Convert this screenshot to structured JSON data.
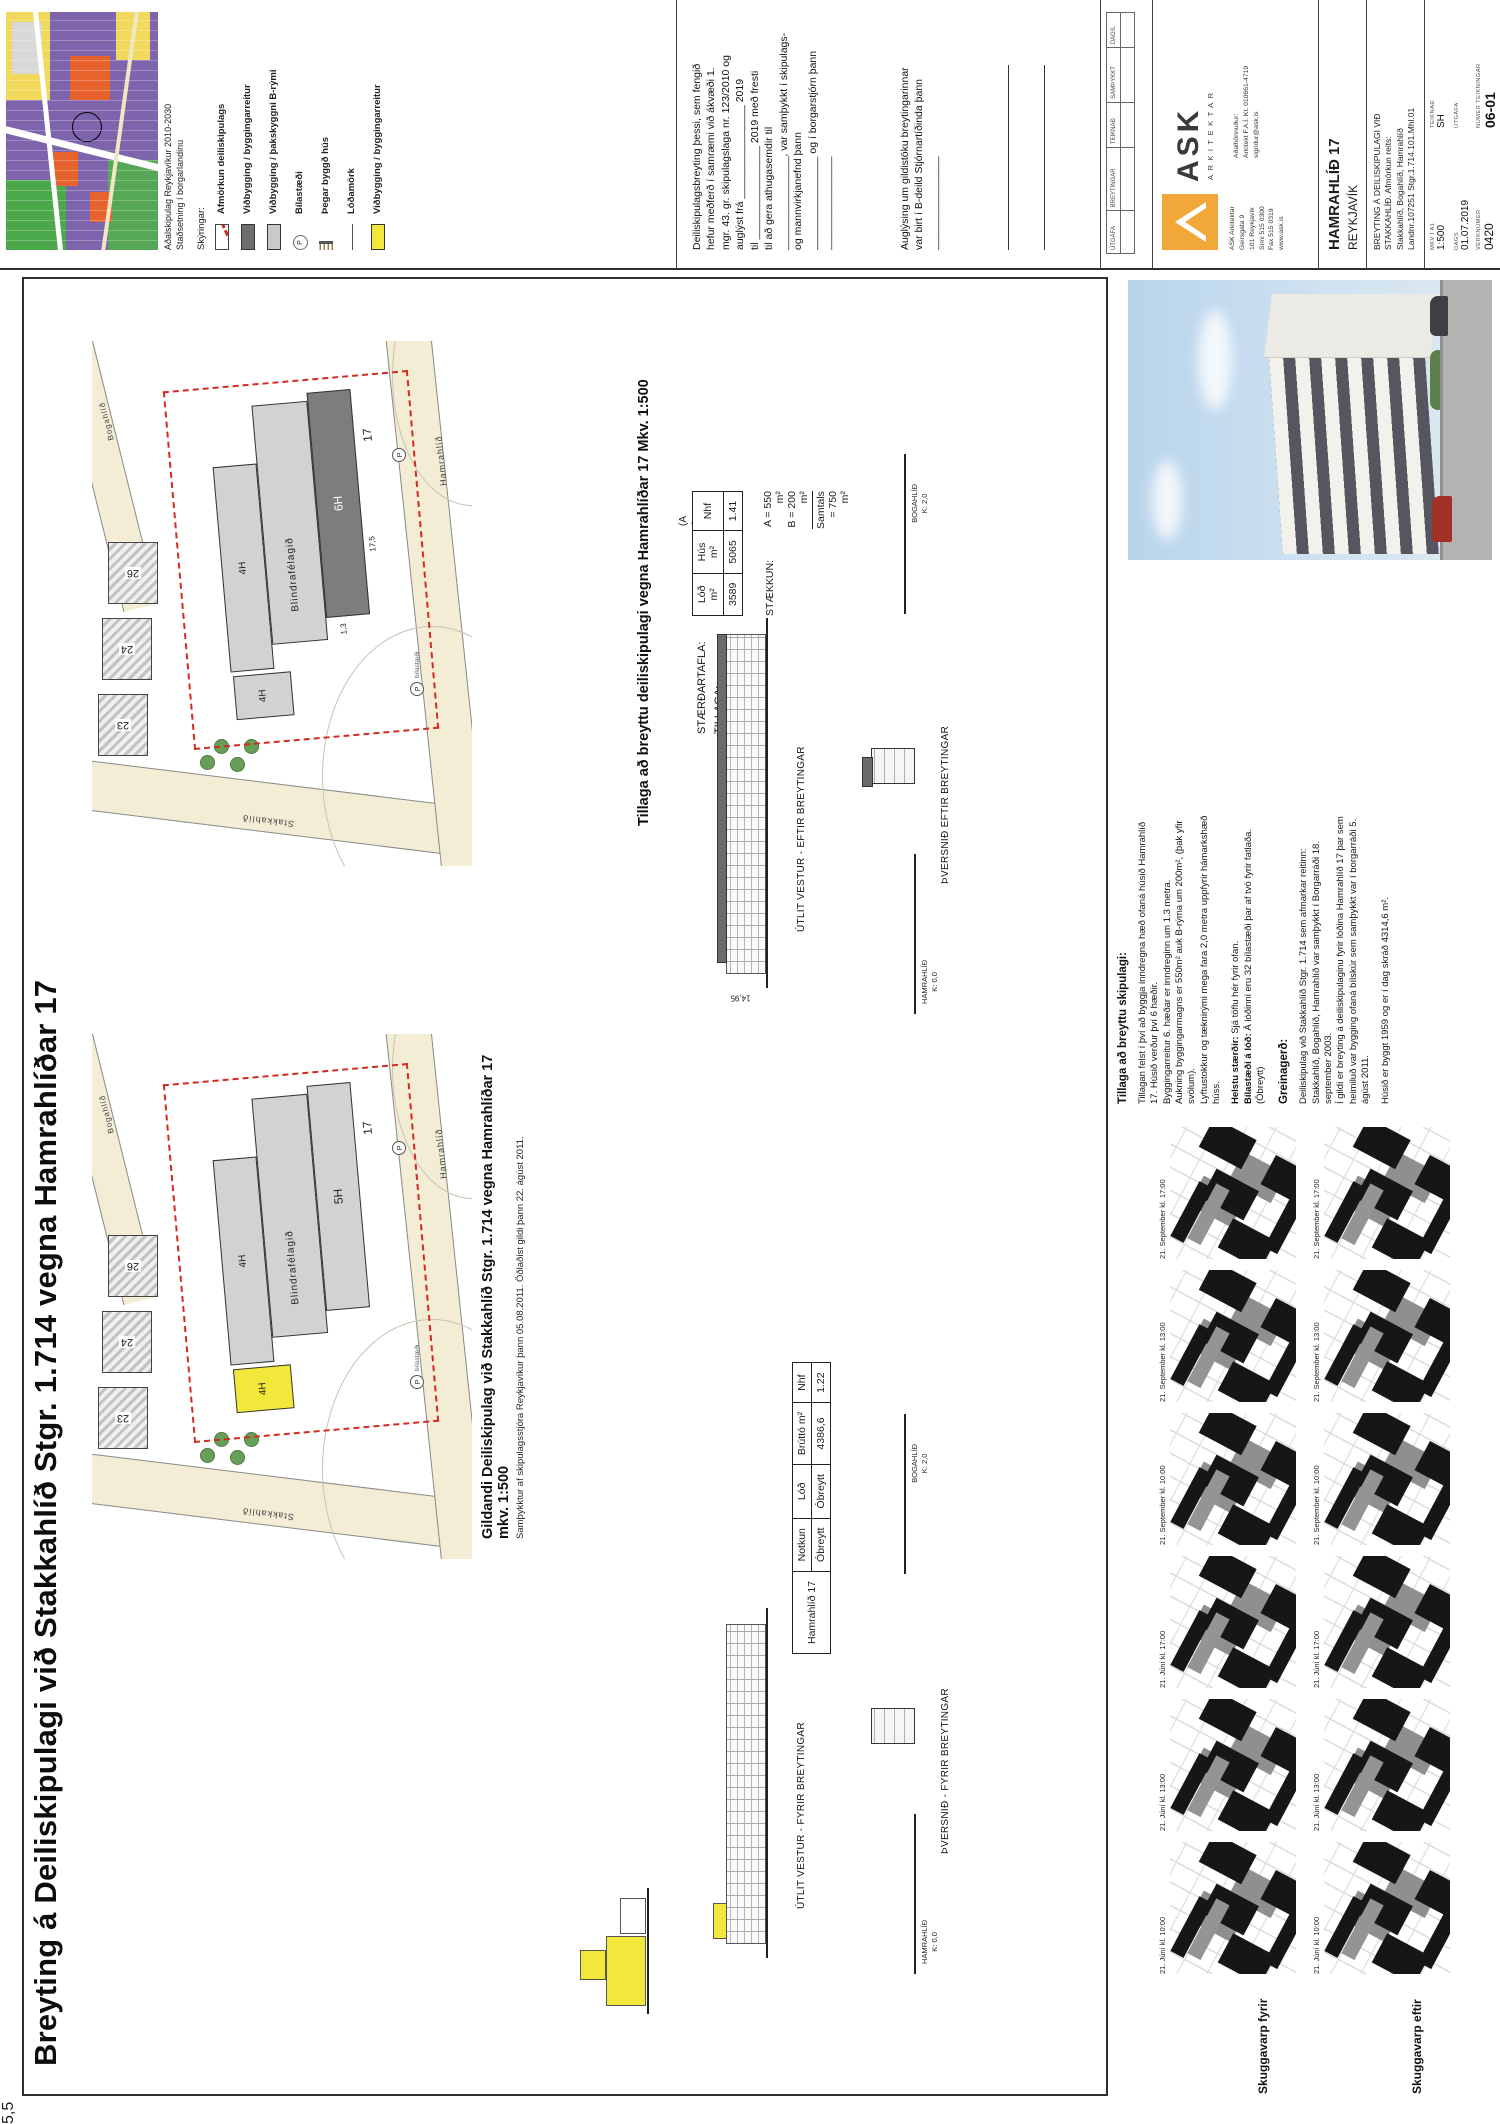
{
  "colors": {
    "accent_yellow": "#F2E83B",
    "boundary_red": "#D42A20",
    "ask_orange": "#F2A838",
    "addition_gray": "#6B6B6B"
  },
  "main_title": "Breyting á Deiliskipulagi við Stakkahlíð Stgr. 1.714 vegna Hamrahlíðar 17",
  "header": {
    "map_caption_line1": "Aðalskipulag Reykjavíkur 2010-2030",
    "map_caption_line2": "Staðsetning í borgarlandinu",
    "legend_title": "Skýringar:",
    "legend": [
      {
        "symbol": "red-dashed-box",
        "label": "Afmörkun deiliskipulags"
      },
      {
        "symbol": "dark-gray-box",
        "label": "Viðbygging / byggingarreitur"
      },
      {
        "symbol": "light-gray-box",
        "label": "Viðbygging / þakskyggni B-rými"
      },
      {
        "symbol": "p-circle",
        "label": "Bílastæði"
      },
      {
        "symbol": "hatched-line",
        "label": "Þegar byggð hús"
      },
      {
        "symbol": "thin-line",
        "label": "Lóðamörk"
      },
      {
        "symbol": "yellow-box",
        "label": "Viðbygging / byggingarreitur"
      }
    ],
    "declaration": "Deiliskipulagsbreyting þessi, sem fengið\nhefur meðferð í samræmi við ákvæði 1.\nmgr. 43. gr. skipulagslaga nr. 123/2010 og\nauglýst frá ________________ 2019\ntil ________________ 2019  með fresti\ntil að gera athugasemdir til\n________________, var samþykkt í skipulags-\nog mannvirkjanefnd þann\n________________ og í borgarstjórn þann\n________________",
    "announcement": "Auglýsing um gildistöku breytingarinnar\nvar birt í B-deild Stjórnartíðinda þann\n________________"
  },
  "titleblock": {
    "revision_headers": [
      "ÚTGÁFA",
      "BREYTINGAR",
      "TEIKNAÐ",
      "SAMÞYKKT",
      "DAGS."
    ],
    "logo_text": "ASK",
    "logo_sub": "ARKITEKTAR",
    "address": "ASK Arkitektar\nGeirsgata 9\n101 Reykjavík\nSími 515 0300\nFax 515 0319\nwww.ask.is",
    "designer_label": "Aðalhönnuður:",
    "designer_info": "Arkitekt F.A.Í.  Kt. 010661-4719",
    "designer_email": "sigridur@ask.is",
    "project_title": "HAMRAHLÍÐ 17",
    "project_city": "REYKJAVÍK",
    "drawing_title": "BREYTING Á DEILISKIPULAGI VIÐ\nSTAKKAHLÍÐ. Afmörkun reits:\nStakkahlíð, Bogahlíð, Hamrahlíð\nLandnr.107251 Stgr.1.714.101.Mhl.01",
    "scale_label": "MKV Í A1",
    "scale_value": "1:500",
    "drawn_label": "TEIKNAÐ",
    "drawn_value": "SH",
    "date_label": "DAGS",
    "date_value": "01.07.2019",
    "issue_label": "ÚTGÁFA",
    "issue_value": "",
    "job_label": "VERKNÚMER",
    "job_value": "0420",
    "sheet_label": "NÚMER TEIKNINGAR",
    "sheet_value": "06-01"
  },
  "plan_existing": {
    "caption": "Gildandi Deiliskipulag við Stakkahlíð Stgr. 1.714 vegna Hamrahlíðar 17 mkv. 1:500",
    "subcaption": "Samþykktur af skipulagsstjóra Reykjavíkur þann 05.08.2011. Öðlaðist gildi þann 22. ágúst 2011.",
    "building_name": "Blindrafélagið",
    "floors_main": "5H",
    "floors_wing1": "4H",
    "floors_wing2": "4H",
    "house_number": "17",
    "neighbors": [
      "23",
      "24",
      "26"
    ],
    "street_left": "Stakkahlíð",
    "street_bottom": "Hamrahlíð",
    "street_top": "Bogahlíð",
    "parking": "P",
    "parking_label": "bílastæði"
  },
  "plan_proposed": {
    "caption": "Tillaga að breyttu deiliskipulagi vegna Hamrahlíðar 17 Mkv. 1:500",
    "building_name": "Blindrafélagið",
    "floors_main": "6H",
    "floors_wing1": "4H",
    "floors_wing2": "4H",
    "dim1": "17,5",
    "dim2": "1,3",
    "house_number": "17",
    "neighbors": [
      "23",
      "24",
      "26"
    ],
    "street_left": "Stakkahlíð",
    "street_bottom": "Hamrahlíð",
    "street_top": "Bogahlíð",
    "parking": "P",
    "parking_label": "bílastæði"
  },
  "size_table": {
    "title_line1": "STÆRÐARTAFLA:",
    "title_line2": "TILLAGA:",
    "ab_note": "(A + B)",
    "headers": [
      "Lóð m²",
      "Hús m²",
      "Nhf"
    ],
    "values": [
      "3589",
      "5065",
      "1.41"
    ],
    "staekkun_label": "STÆKKUN:",
    "staekkun_a": "A = 550 m²",
    "staekkun_b": "B = 200 m²",
    "staekkun_total": "Samtals = 750 m²"
  },
  "existing_table": {
    "row_header": "Hamrahlíð 17",
    "headers": [
      "Notkun",
      "Lóð",
      "Brúttó m²",
      "Nhf"
    ],
    "values": [
      "Óbreytt",
      "Óbreytt",
      "4386,6",
      "1.22"
    ]
  },
  "elevations": {
    "utlit_eftir": "ÚTLIT VESTUR - EFTIR BREYTINGAR",
    "thversnid_eftir": "ÞVERSNIÐ EFTIR BREYTINGAR",
    "utlit_fyrir": "ÚTLIT VESTUR - FYRIR BREYTINGAR",
    "thversnid_fyrir": "ÞVERSNIÐ - FYRIR BREYTINGAR",
    "dim_height": "14,95",
    "dim_top": "5,5",
    "street_low": "HAMRAHLÍÐ\nK: 0,0",
    "street_high": "BOGAHLÍÐ\nK: 2,0"
  },
  "narrative": {
    "heading": "Tillaga að breyttu skipulagi:",
    "p1": "Tillagan felst í því að byggja inndregna hæð ofaná  húsið Hamrahlíð\n17. Húsið verður því 6 hæðir.\nByggingarreitur 6. hæðar er inndreginn um 1.3 metra.\nAukning byggingarmagns er 550m²  auk B-rýma um 200m², (þak yfir\nsvölum).\nLyftustokkur og tæknirými mega fara 2,0 metra uppfyrir hámarkshæð\nhúss.",
    "p2_label": "Helstu stærðir:",
    "p2": "Sjá töflu hér fyrir ofan.",
    "p3_label": "Bílastæði á lóð:",
    "p3": "Á lóðinni eru 32 bílastæði þar af tvö fyrir fatlaða.\n(Óbreytt)",
    "greinagerd_heading": "Greinagerð:",
    "g1": "Deiliskipulag við Stakkahlíð Stgr. 1.714 sem afmarkar reitinn:\nStakkahlíð, Bogahlíð, Hamrahlíð var samþykkt í Borgarráði 18.\nseptember 2003.\nÍ gildi er breyting á deiliskipulaginu fyrir lóðina Hamrahlíð 17 þar sem\nheimiluð var bygging ofaná bílskúr sem samþykkt var í borgarráði 5.\nágúst 2011.",
    "g2": "Húsið er byggt 1959 og er í dag skráð 4314,6 m²."
  },
  "shadows": {
    "caption_before": "Skuggavarp fyrir",
    "caption_after": "Skuggavarp eftir",
    "times": [
      "21. Júní kl. 10:00",
      "21. Júní kl. 13:00",
      "21. Júní kl. 17:00",
      "21. September kl. 10:00",
      "21. September kl. 13:00",
      "21. September kl. 17:00"
    ]
  }
}
